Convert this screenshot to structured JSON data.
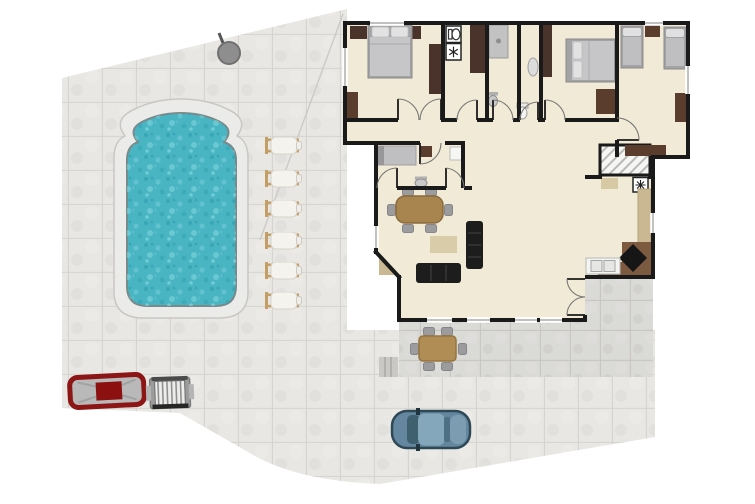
{
  "scene": {
    "type": "floor-plan",
    "view": "top-down",
    "description": "2D floor plan of a villa plot with swimming pool, sun loungers, patio, driveway and parked cars"
  },
  "colors": {
    "background": "#ffffff",
    "wall": "#1a1a1a",
    "floor": "#f1ead7",
    "yard_tile": "#e5e4e0",
    "patio_tile": "#d7d6d2",
    "pool_water": "#49b4c2",
    "pool_deck": "#ebebe9",
    "wood_dark": "#4a332a",
    "wood_mid": "#5b3d2e",
    "counter_tan": "#c9b892",
    "counter_brown": "#7c5a40",
    "table_wood": "#a8854f",
    "outdoor_table_wood": "#b08d55",
    "sofa_black": "#1d1d1d",
    "rug_tan": "#d9cda9",
    "bed_gray": "#c6c6c8",
    "chair_gray": "#9c9c9e",
    "lounger_frame": "#c59e66",
    "lounger_pad": "#f4f3ee",
    "car_red": "#8c1616",
    "car_blue": "#64879f",
    "grill_gray": "#9c9c9c"
  },
  "outdoor": {
    "pool": {
      "name": "swimming-pool",
      "shape": "rounded rectangle with arched top"
    },
    "sun_loungers": {
      "count": 6
    },
    "outdoor_shower": {
      "present": true
    },
    "cars": [
      {
        "name": "red-car",
        "location": "bottom-left"
      },
      {
        "name": "blue-car",
        "location": "driveway"
      }
    ],
    "bbq_grill": {
      "present": true,
      "location": "next to red car"
    },
    "outdoor_dining": {
      "tables": 1,
      "chairs": 6,
      "location": "patio"
    },
    "patio_steps": {
      "present": true
    }
  },
  "house": {
    "bedrooms": [
      {
        "name": "master-bedroom",
        "bed": "double",
        "wardrobes": 3
      },
      {
        "name": "second-bedroom",
        "bed": "double",
        "wardrobes": 2
      },
      {
        "name": "twin-bedroom",
        "beds": "2 singles",
        "nightstand": true
      }
    ],
    "bathrooms": [
      {
        "name": "wc-laundry",
        "fixtures": [
          "toilet",
          "washing-machine",
          "linen-closet"
        ]
      },
      {
        "name": "shower-room",
        "fixtures": [
          "shower",
          "basin"
        ]
      },
      {
        "name": "wc",
        "fixtures": [
          "boiler",
          "toilet"
        ]
      }
    ],
    "study": {
      "fixtures": [
        "daybed",
        "nightstand",
        "basin",
        "white-unit"
      ]
    },
    "living_dining": {
      "sofas": 2,
      "dining_seats": 6,
      "rug": true,
      "corner_unit": true
    },
    "kitchen": {
      "fixtures": [
        "double-sink",
        "corner-stove",
        "counters",
        "freezer-unit"
      ]
    },
    "stairs": {
      "present": true,
      "style": "hatched"
    },
    "french_doors": {
      "present": true,
      "to": "patio"
    }
  },
  "icons": [
    {
      "name": "toilet-icon"
    },
    {
      "name": "washing-machine-icon"
    },
    {
      "name": "snowflake-icon"
    }
  ]
}
